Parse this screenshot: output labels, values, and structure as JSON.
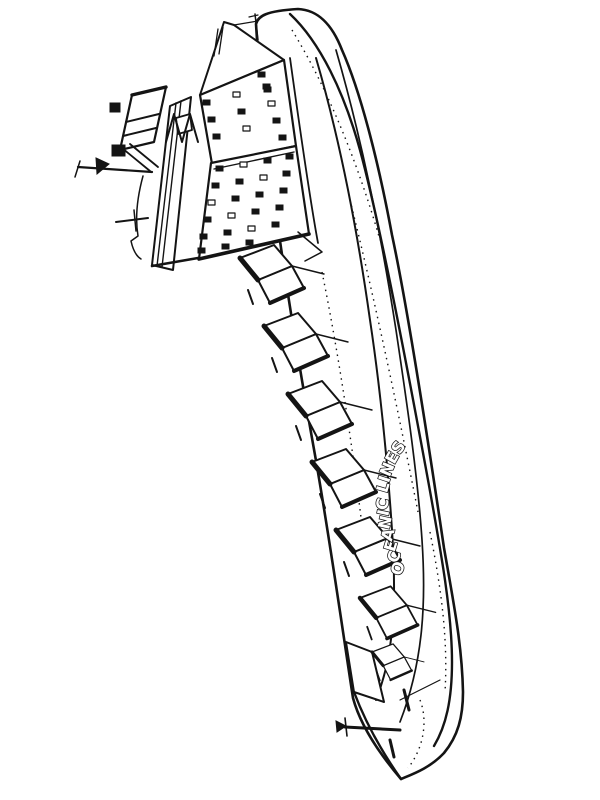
{
  "page": {
    "background_color": "#ffffff",
    "line_color": "#141414"
  },
  "ship": {
    "name_text": "OCEANIC LINES"
  }
}
